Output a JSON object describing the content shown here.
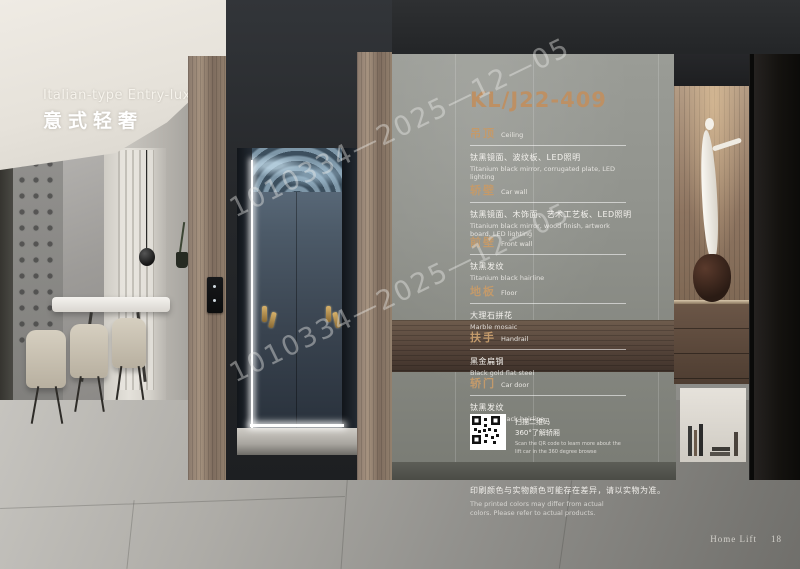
{
  "header": {
    "series_en": "Italian-type Entry-lux",
    "series_zh": "意式轻奢"
  },
  "panel": {
    "model": "KL/J22-409",
    "sections": [
      {
        "title_zh": "吊顶",
        "title_en": "Ceiling",
        "desc_zh": "钛黑镜面、波纹板、LED照明",
        "desc_en": "Titanium black mirror, corrugated plate, LED lighting"
      },
      {
        "title_zh": "轿壁",
        "title_en": "Car wall",
        "desc_zh": "钛黑镜面、木饰面、艺术工艺板、LED照明",
        "desc_en": "Titanium black mirror, wood finish, artwork board, LED lighting"
      },
      {
        "title_zh": "前壁",
        "title_en": "Front wall",
        "desc_zh": "钛黑发纹",
        "desc_en": "Titanium black hairline"
      },
      {
        "title_zh": "地板",
        "title_en": "Floor",
        "desc_zh": "大理石拼花",
        "desc_en": "Marble mosaic"
      },
      {
        "title_zh": "扶手",
        "title_en": "Handrail",
        "desc_zh": "黑金扁钢",
        "desc_en": "Black gold flat steel"
      },
      {
        "title_zh": "轿门",
        "title_en": "Car door",
        "desc_zh": "钛黑发纹",
        "desc_en": "Titanium black hairline"
      }
    ],
    "qr": {
      "caption_zh_1": "扫描二维码",
      "caption_zh_2": "360°了解轿厢",
      "caption_en": "Scan the QR code to learn more about the lift car in the 360 degree browse"
    },
    "disclaimer_zh": "印刷颜色与实物颜色可能存在差异，请以实物为准。",
    "disclaimer_en": "The printed colors may differ from actual colors. Please refer to actual products."
  },
  "watermark": "1010334—2025—12—05",
  "footer": {
    "brand": "Home Lift",
    "page": "18"
  },
  "colors": {
    "accent_gold": "#bd9064",
    "panel_gray": "#90928c"
  }
}
